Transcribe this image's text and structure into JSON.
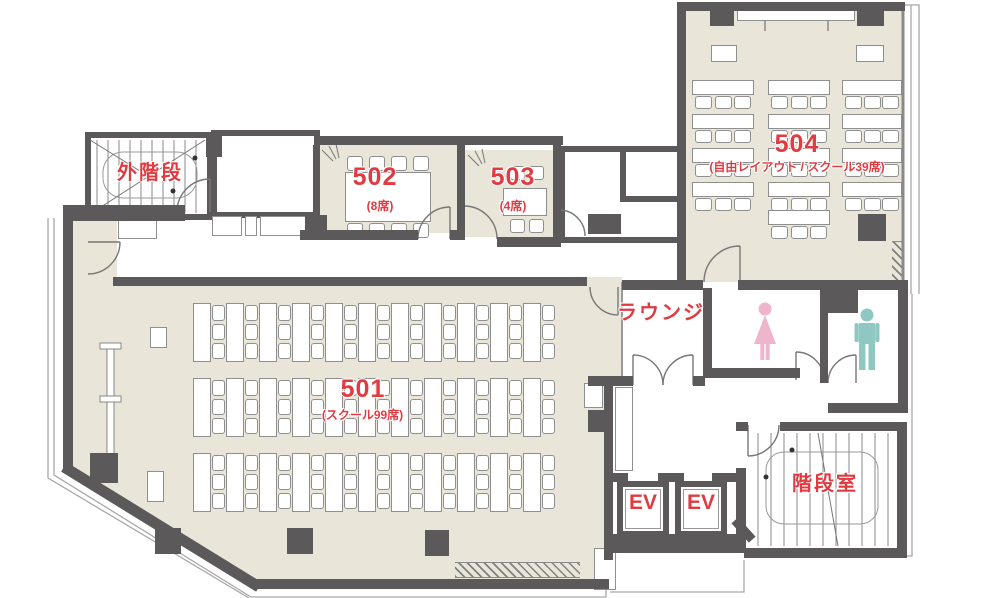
{
  "colors": {
    "accent_red": "#df3b41",
    "floor_beige": "#e9e5d9",
    "wall_gray": "#5b5959",
    "female_pink": "#efb5cd",
    "male_teal": "#8fc8c3"
  },
  "rooms": {
    "outside_stairs": {
      "label": "外階段"
    },
    "room_502": {
      "number": "502",
      "capacity": "(8席)"
    },
    "room_503": {
      "number": "503",
      "capacity": "(4席)"
    },
    "room_504": {
      "number": "504",
      "capacity": "(自由レイアウト / スクール39席)"
    },
    "room_501": {
      "number": "501",
      "capacity": "(スクール99席)"
    },
    "lounge": {
      "label": "ラウンジ"
    },
    "stairwell": {
      "label": "階段室"
    },
    "elevator_1": {
      "label": "EV"
    },
    "elevator_2": {
      "label": "EV"
    }
  },
  "icons": {
    "female_restroom": "female-restroom-icon",
    "male_restroom": "male-restroom-icon"
  }
}
